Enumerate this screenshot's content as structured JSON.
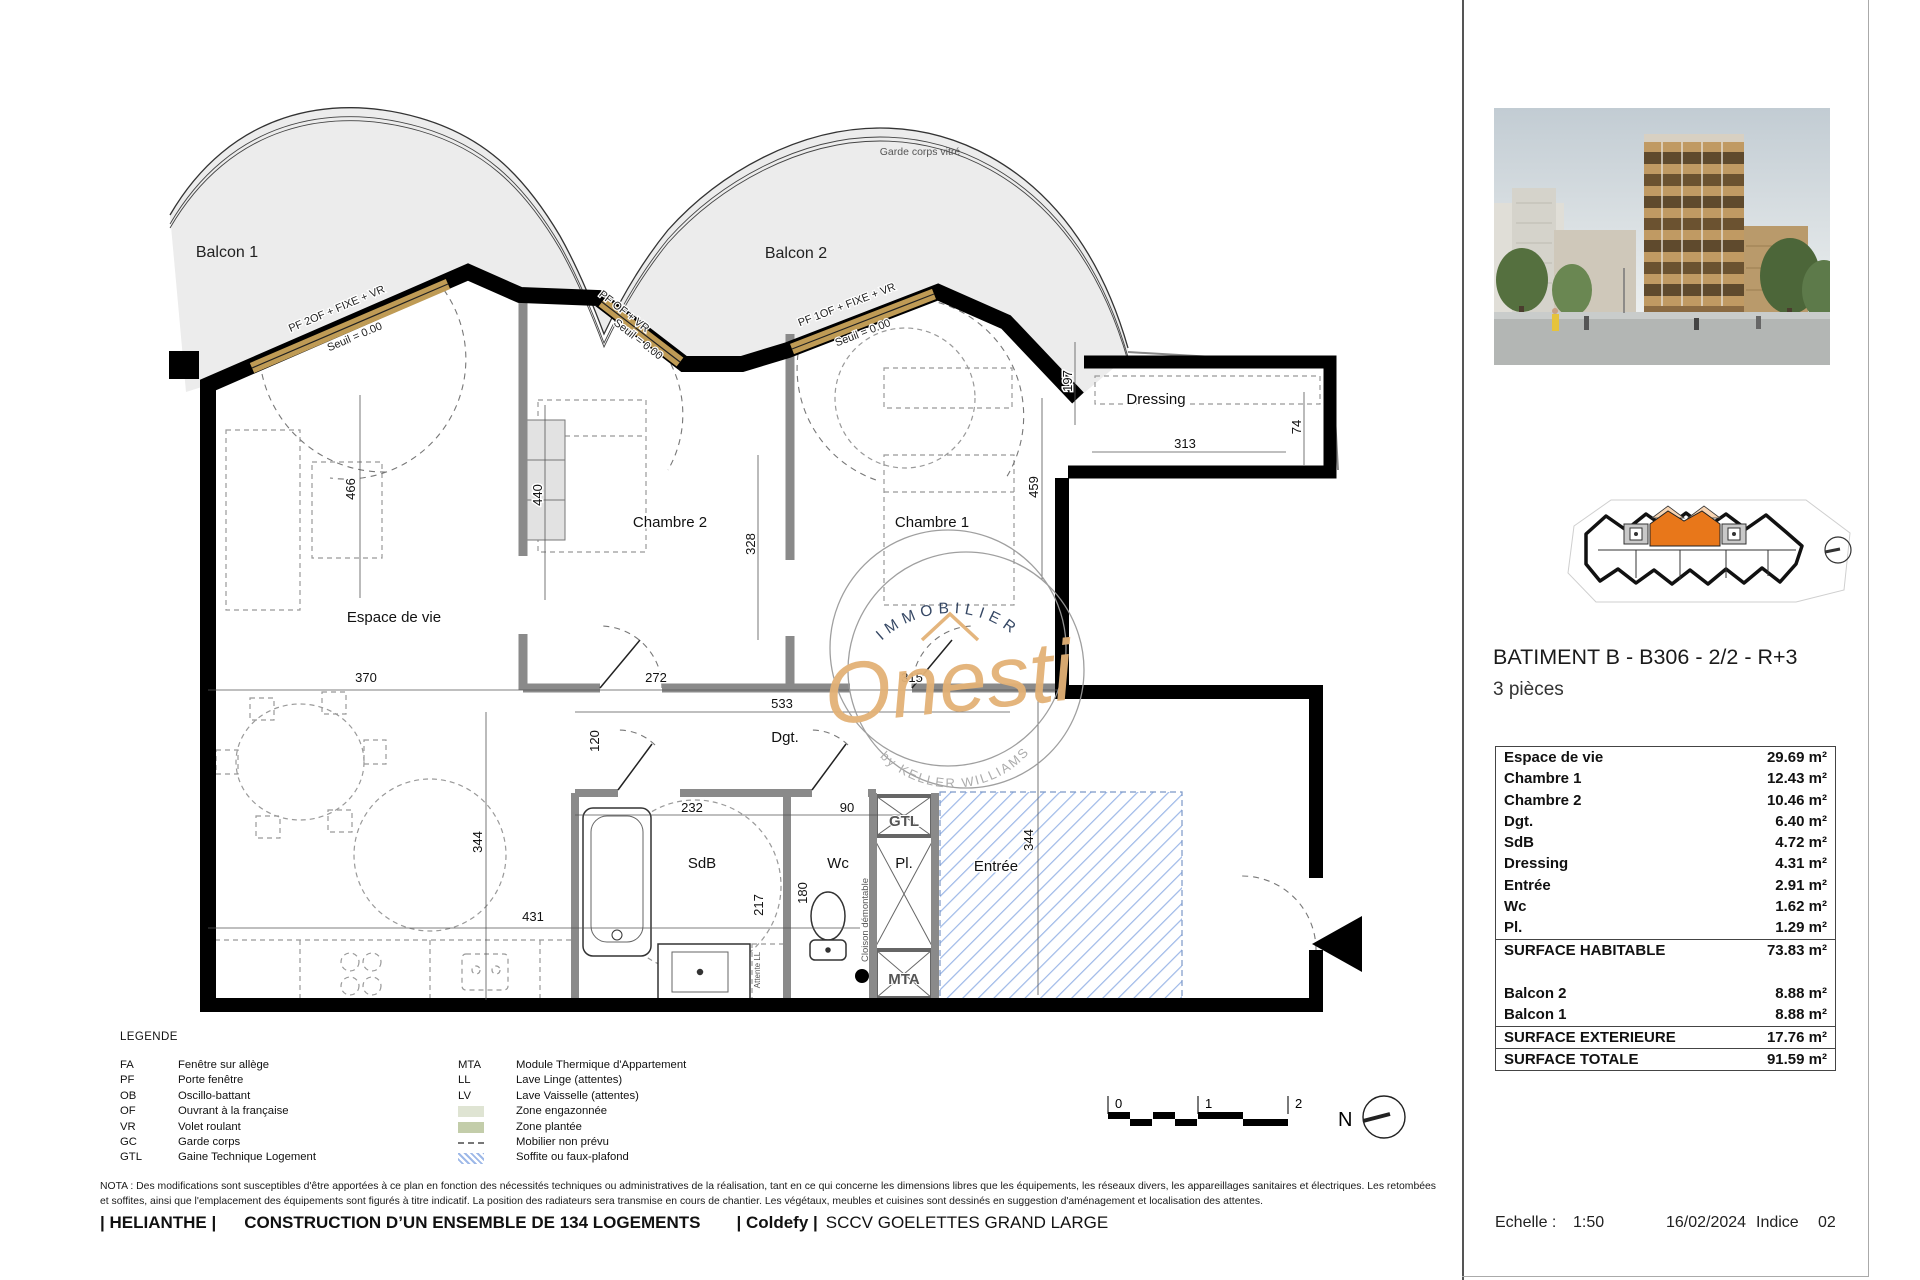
{
  "plan": {
    "balcon1": "Balcon 1",
    "balcon2": "Balcon 2",
    "garde_corps": "Garde corps vitré",
    "rooms": {
      "espace": "Espace de vie",
      "chambre2": "Chambre 2",
      "chambre1": "Chambre 1",
      "dressing": "Dressing",
      "dgt": "Dgt.",
      "sdb": "SdB",
      "wc": "Wc",
      "pl": "Pl.",
      "entree": "Entrée"
    },
    "windows": {
      "w1": "PF 2OF + FIXE + VR",
      "w2": "PF OF + VR",
      "w3": "PF 1OF + FIXE + VR",
      "seuil": "Seuil = 0.00"
    },
    "annotations": {
      "gtl": "GTL",
      "mta": "MTA",
      "cloison": "Cloison démontable",
      "attente_ll": "Attente LL"
    },
    "dims": [
      "466",
      "440",
      "328",
      "459",
      "197",
      "313",
      "74",
      "370",
      "272",
      "315",
      "533",
      "120",
      "344",
      "232",
      "90",
      "217",
      "180",
      "431",
      "344"
    ]
  },
  "watermark": {
    "top": "IMMOBILIER",
    "name": "Onesti",
    "bottom": "by KELLER WILLIAMS"
  },
  "scale_bar": {
    "t0": "0",
    "t1": "1",
    "t2": "2"
  },
  "north_label": "N",
  "legend": {
    "title": "LEGENDE",
    "left": [
      {
        "abbr": "FA",
        "label": "Fenêtre sur allège"
      },
      {
        "abbr": "PF",
        "label": "Porte fenêtre"
      },
      {
        "abbr": "OB",
        "label": "Oscillo-battant"
      },
      {
        "abbr": "OF",
        "label": "Ouvrant à la française"
      },
      {
        "abbr": "VR",
        "label": "Volet roulant"
      },
      {
        "abbr": "GC",
        "label": "Garde corps"
      },
      {
        "abbr": "GTL",
        "label": "Gaine Technique Logement"
      }
    ],
    "right": [
      {
        "abbr": "MTA",
        "label": "Module Thermique d'Appartement"
      },
      {
        "abbr": "LL",
        "label": "Lave Linge (attentes)"
      },
      {
        "abbr": "LV",
        "label": "Lave Vaisselle (attentes)"
      },
      {
        "abbr": "",
        "label": "Zone engazonnée"
      },
      {
        "abbr": "",
        "label": "Zone plantée"
      },
      {
        "abbr": "",
        "label": "Mobilier non prévu"
      },
      {
        "abbr": "",
        "label": "Soffite ou faux-plafond"
      }
    ]
  },
  "nota_line1": "NOTA : Des modifications sont susceptibles d'être apportées à ce plan en fonction des nécessités techniques ou administratives de la réalisation, tant en ce qui concerne les dimensions libres que les équipements, les réseaux divers, les appareillages sanitaires et électriques. Les retombées",
  "nota_line2": "et soffites, ainsi que l'emplacement des équipements sont figurés à titre indicatif. La position des radiateurs sera transmise en cours de chantier. Les végétaux, meubles et cuisines sont dessinés en suggestion d'aménagement et localisation des attentes.",
  "footer": {
    "p1": "| HELIANTHE |",
    "p2": "CONSTRUCTION D’UN ENSEMBLE DE 134 LOGEMENTS",
    "p3": "| Coldefy |",
    "p4": "SCCV GOELETTES GRAND LARGE"
  },
  "sidebar": {
    "title": "BATIMENT B - B306 - 2/2 - R+3",
    "subtitle": "3 pièces",
    "table": {
      "rows": [
        {
          "label": "Espace de vie",
          "value": "29.69 m²"
        },
        {
          "label": "Chambre 1",
          "value": "12.43 m²"
        },
        {
          "label": "Chambre 2",
          "value": "10.46 m²"
        },
        {
          "label": "Dgt.",
          "value": "6.40 m²"
        },
        {
          "label": "SdB",
          "value": "4.72 m²"
        },
        {
          "label": "Dressing",
          "value": "4.31 m²"
        },
        {
          "label": "Entrée",
          "value": "2.91 m²"
        },
        {
          "label": "Wc",
          "value": "1.62 m²"
        },
        {
          "label": "Pl.",
          "value": "1.29 m²"
        },
        {
          "label": "SURFACE HABITABLE",
          "value": "73.83 m²"
        },
        {
          "label": "Balcon 2",
          "value": "8.88 m²"
        },
        {
          "label": "Balcon 1",
          "value": "8.88 m²"
        },
        {
          "label": "SURFACE EXTERIEURE",
          "value": "17.76 m²"
        },
        {
          "label": "SURFACE TOTALE",
          "value": "91.59 m²"
        }
      ]
    },
    "echelle_label": "Echelle :",
    "echelle_value": "1:50",
    "date": "16/02/2024",
    "indice_label": "Indice",
    "indice_value": "02"
  }
}
